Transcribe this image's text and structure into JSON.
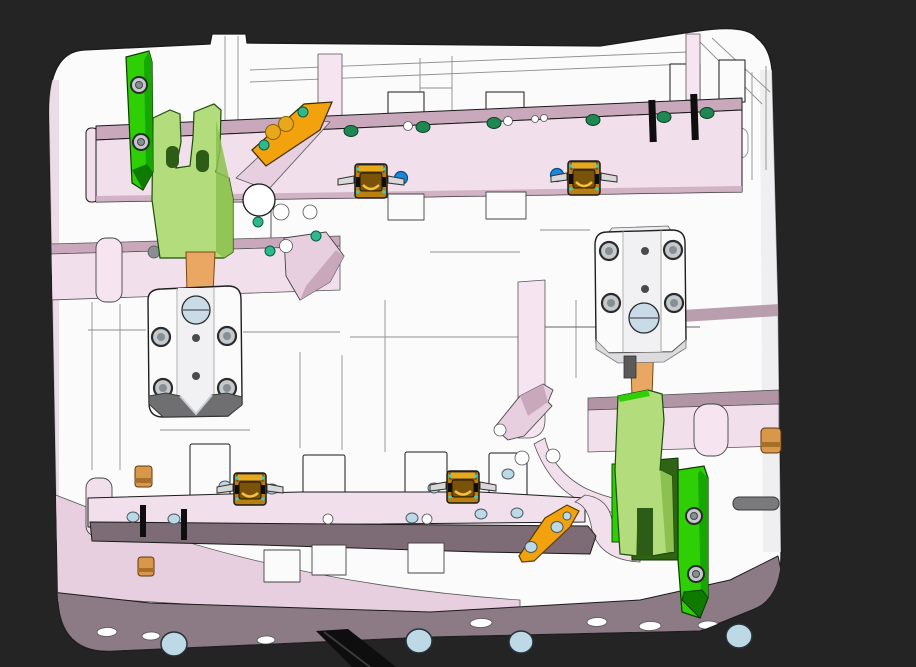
{
  "scene": {
    "type": "cad-3d-viewport",
    "description": "3D CAD shaded view of an injection-mold fixture plate assembly with clamp hardware",
    "visible_text": ""
  },
  "colors": {
    "background": "#242424",
    "outline": "#1a1a1a",
    "plate_white": "#fbfbfc",
    "plate_shade": "#e9e9ec",
    "wireframe_gray": "#8f8f8f",
    "pink_light": "#f1dfec",
    "pink_pale": "#f7e4f1",
    "pink_mid": "#e7cfe0",
    "pink_shade": "#c9a8bc",
    "mauve_top": "#b195a5",
    "mauve_front": "#7d6b76",
    "mauve_strip": "#8c7a85",
    "green_bright": "#2fcf06",
    "green_bevel": "#17a800",
    "green_dark_tip": "#0f7a00",
    "green_light": "#b3dd7c",
    "green_shadow": "#8cc150",
    "green_deep": "#2e6414",
    "green_slot": "#2d5c16",
    "teal_dot": "#2eb98c",
    "teal_screw": "#1e8752",
    "blue_dot": "#1d86da",
    "lightblue": "#bdd9e6",
    "steel_light": "#c3c9cc",
    "steel_dark": "#878f93",
    "orange": "#f2a20d",
    "orange_strap": "#e9a763",
    "orange_knob": "#d8974a",
    "gold_body": "#b97f10",
    "gold_light": "#e8a81c",
    "gold_inner": "#7a5208",
    "cyan_speck": "#35d0d0",
    "jaw_gray": "#6f6f72",
    "leg_black": "#0e0e0e",
    "circle_blue": "#c9dbe7"
  },
  "parts": [
    {
      "name": "base-plate",
      "color_ref": "plate_white"
    },
    {
      "name": "top-channel-rail",
      "color_ref": "pink_light",
      "screw_dots": 6
    },
    {
      "name": "bottom-channel-rail",
      "color_ref": "mauve_front"
    },
    {
      "name": "toggle-clamp-unit",
      "color_ref": "gold_body",
      "count": 4
    },
    {
      "name": "clamp-bar-top-left",
      "color_ref": "green_bright",
      "screws": 2
    },
    {
      "name": "clamp-yoke-left",
      "color_ref": "green_light"
    },
    {
      "name": "clamp-bar-bottom-right",
      "color_ref": "green_bright",
      "screws": 2
    },
    {
      "name": "clamp-yoke-right",
      "color_ref": "green_light"
    },
    {
      "name": "slide-block-left",
      "color_ref": "plate_white",
      "screws": 4
    },
    {
      "name": "slide-block-right",
      "color_ref": "plate_white",
      "screws": 4
    },
    {
      "name": "wedge-bracket-top-left",
      "color_ref": "orange",
      "dots": 2
    },
    {
      "name": "wedge-bracket-bottom-right",
      "color_ref": "orange",
      "dots": 3
    },
    {
      "name": "wear-strip",
      "color_ref": "orange_strap",
      "count": 2
    },
    {
      "name": "stop-knob",
      "color_ref": "orange_knob",
      "count": 3
    },
    {
      "name": "support-leg",
      "color_ref": "leg_black"
    },
    {
      "name": "mount-foot",
      "color_ref": "lightblue",
      "count": 4
    }
  ]
}
